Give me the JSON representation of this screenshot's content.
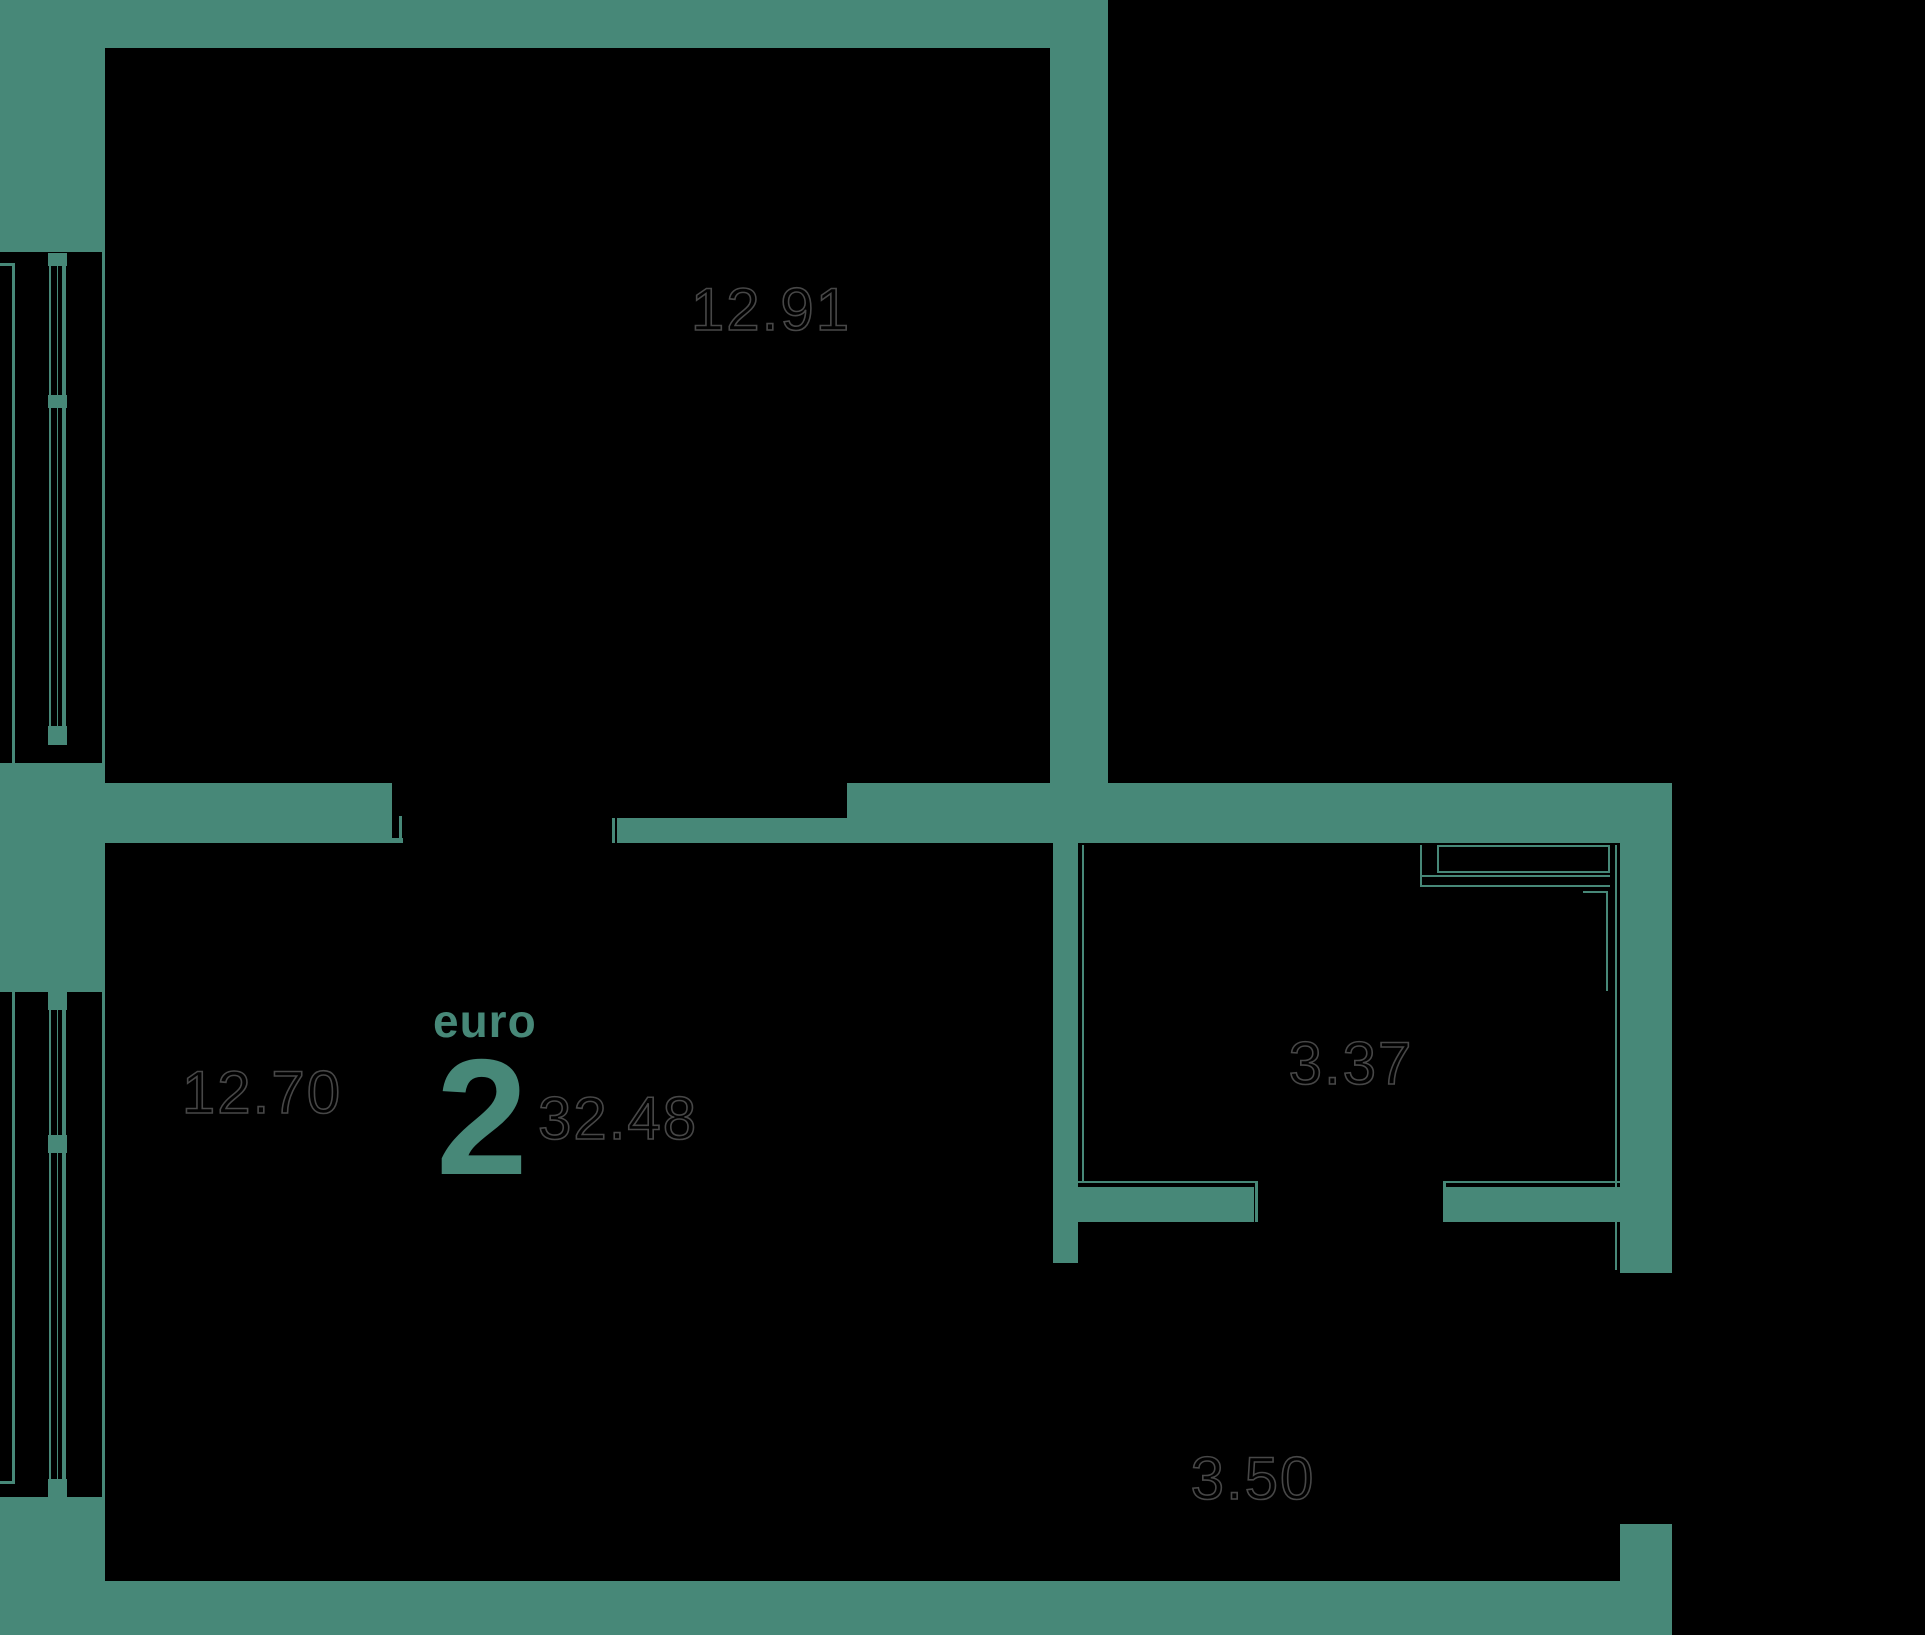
{
  "plan": {
    "unit_badge": {
      "type_label": "euro",
      "rooms_count": "2",
      "total_area": "32.48"
    },
    "rooms": [
      {
        "name": "room-top-left",
        "area": "12.91"
      },
      {
        "name": "room-bottom-left",
        "area": "12.70"
      },
      {
        "name": "room-bathroom",
        "area": "3.37"
      },
      {
        "name": "room-hallway",
        "area": "3.50"
      }
    ],
    "colors": {
      "wall": "#478878",
      "background": "#000000",
      "area_text_outline": "#474747"
    }
  }
}
